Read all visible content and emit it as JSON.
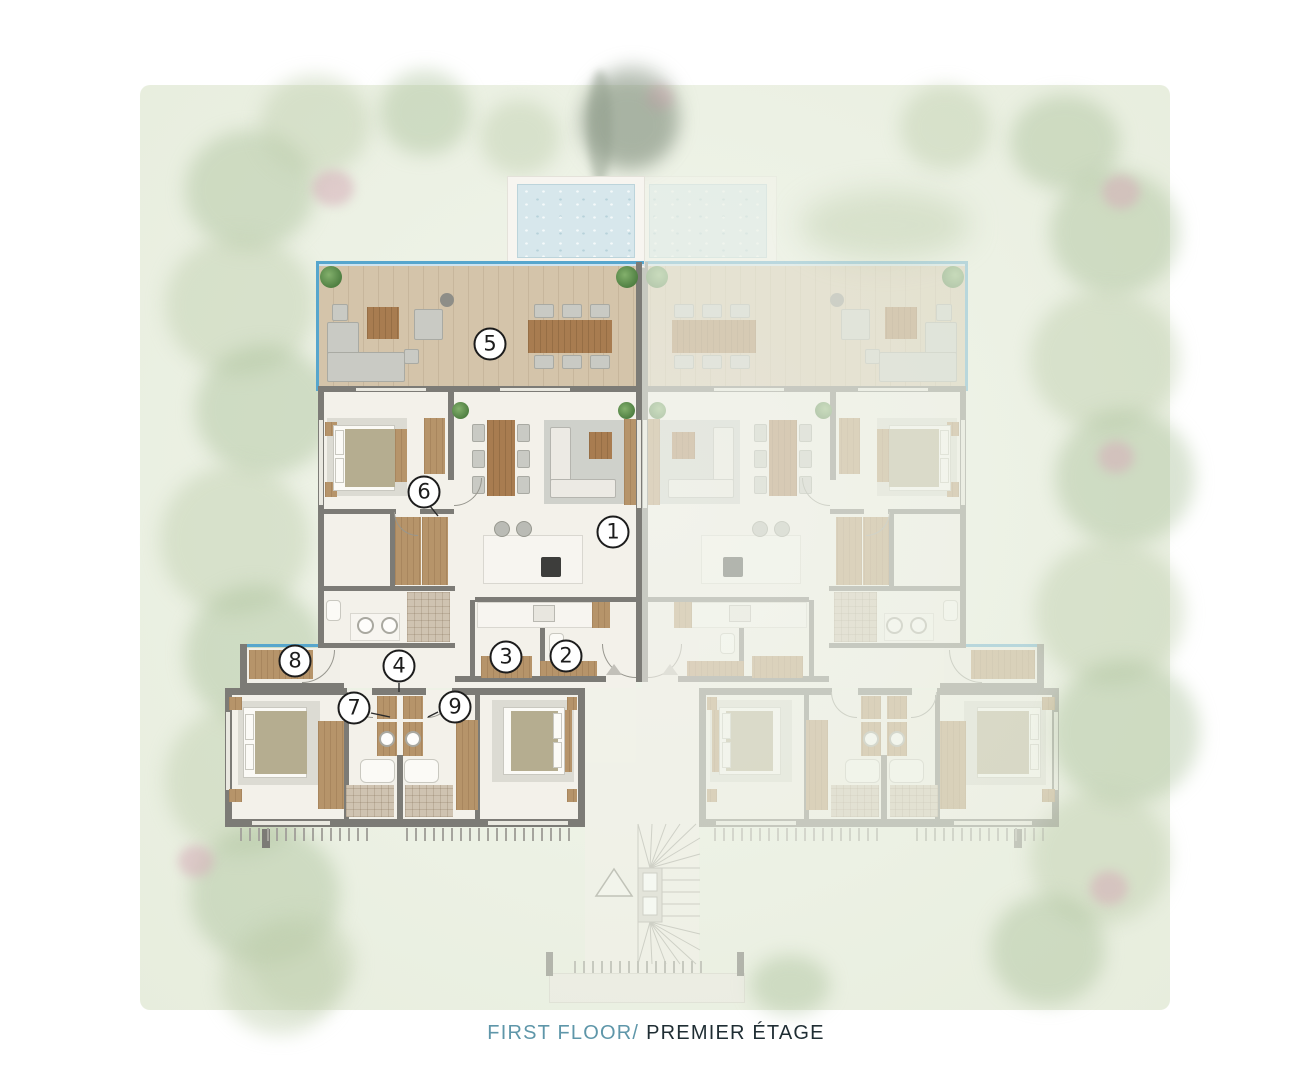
{
  "caption": {
    "first_floor": "FIRST FLOOR/",
    "premier_etage": "PREMIER ÉTAGE"
  },
  "markers": [
    {
      "label": "1"
    },
    {
      "label": "2"
    },
    {
      "label": "3"
    },
    {
      "label": "4"
    },
    {
      "label": "5"
    },
    {
      "label": "6"
    },
    {
      "label": "7"
    },
    {
      "label": "8"
    },
    {
      "label": "9"
    }
  ],
  "colors": {
    "accent_teal": "#5e96a9",
    "caption_dark": "#1f2d33",
    "pool_blue": "#d7e7ec",
    "railing_blue": "#57a6cd",
    "deck_wood": "#d4c4aa",
    "wall_gray": "#7c7b76",
    "furniture_wood": "#a87c50",
    "garden_green": "#ecf1e4"
  }
}
